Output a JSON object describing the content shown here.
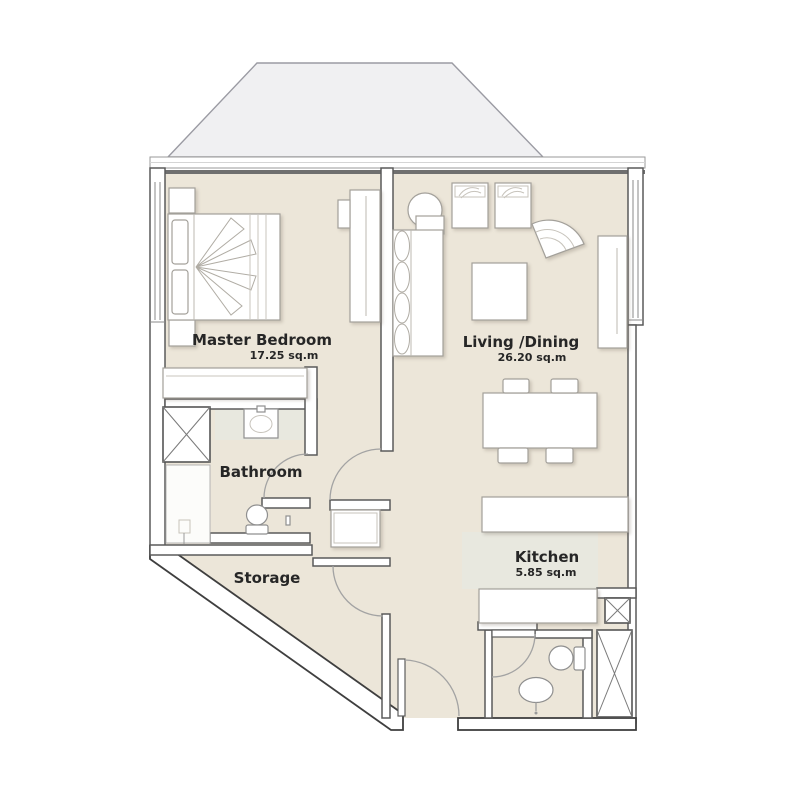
{
  "plan": {
    "rooms": [
      {
        "name": "Master Bedroom",
        "area": "17.25 sq.m"
      },
      {
        "name": "Living /Dining",
        "area": "26.20 sq.m"
      },
      {
        "name": "Bathroom"
      },
      {
        "name": "Storage"
      },
      {
        "name": "Kitchen",
        "area": "5.85 sq.m"
      }
    ],
    "colors": {
      "floor": "#ece6d9",
      "kitchen_floor": "#e8e8df",
      "roof": "#f0f0f2",
      "wall_outline": "#5a5a5a",
      "wall_dark": "#3f3f3f",
      "furniture_outline": "#a3a09a",
      "label_text": "#262626"
    }
  }
}
